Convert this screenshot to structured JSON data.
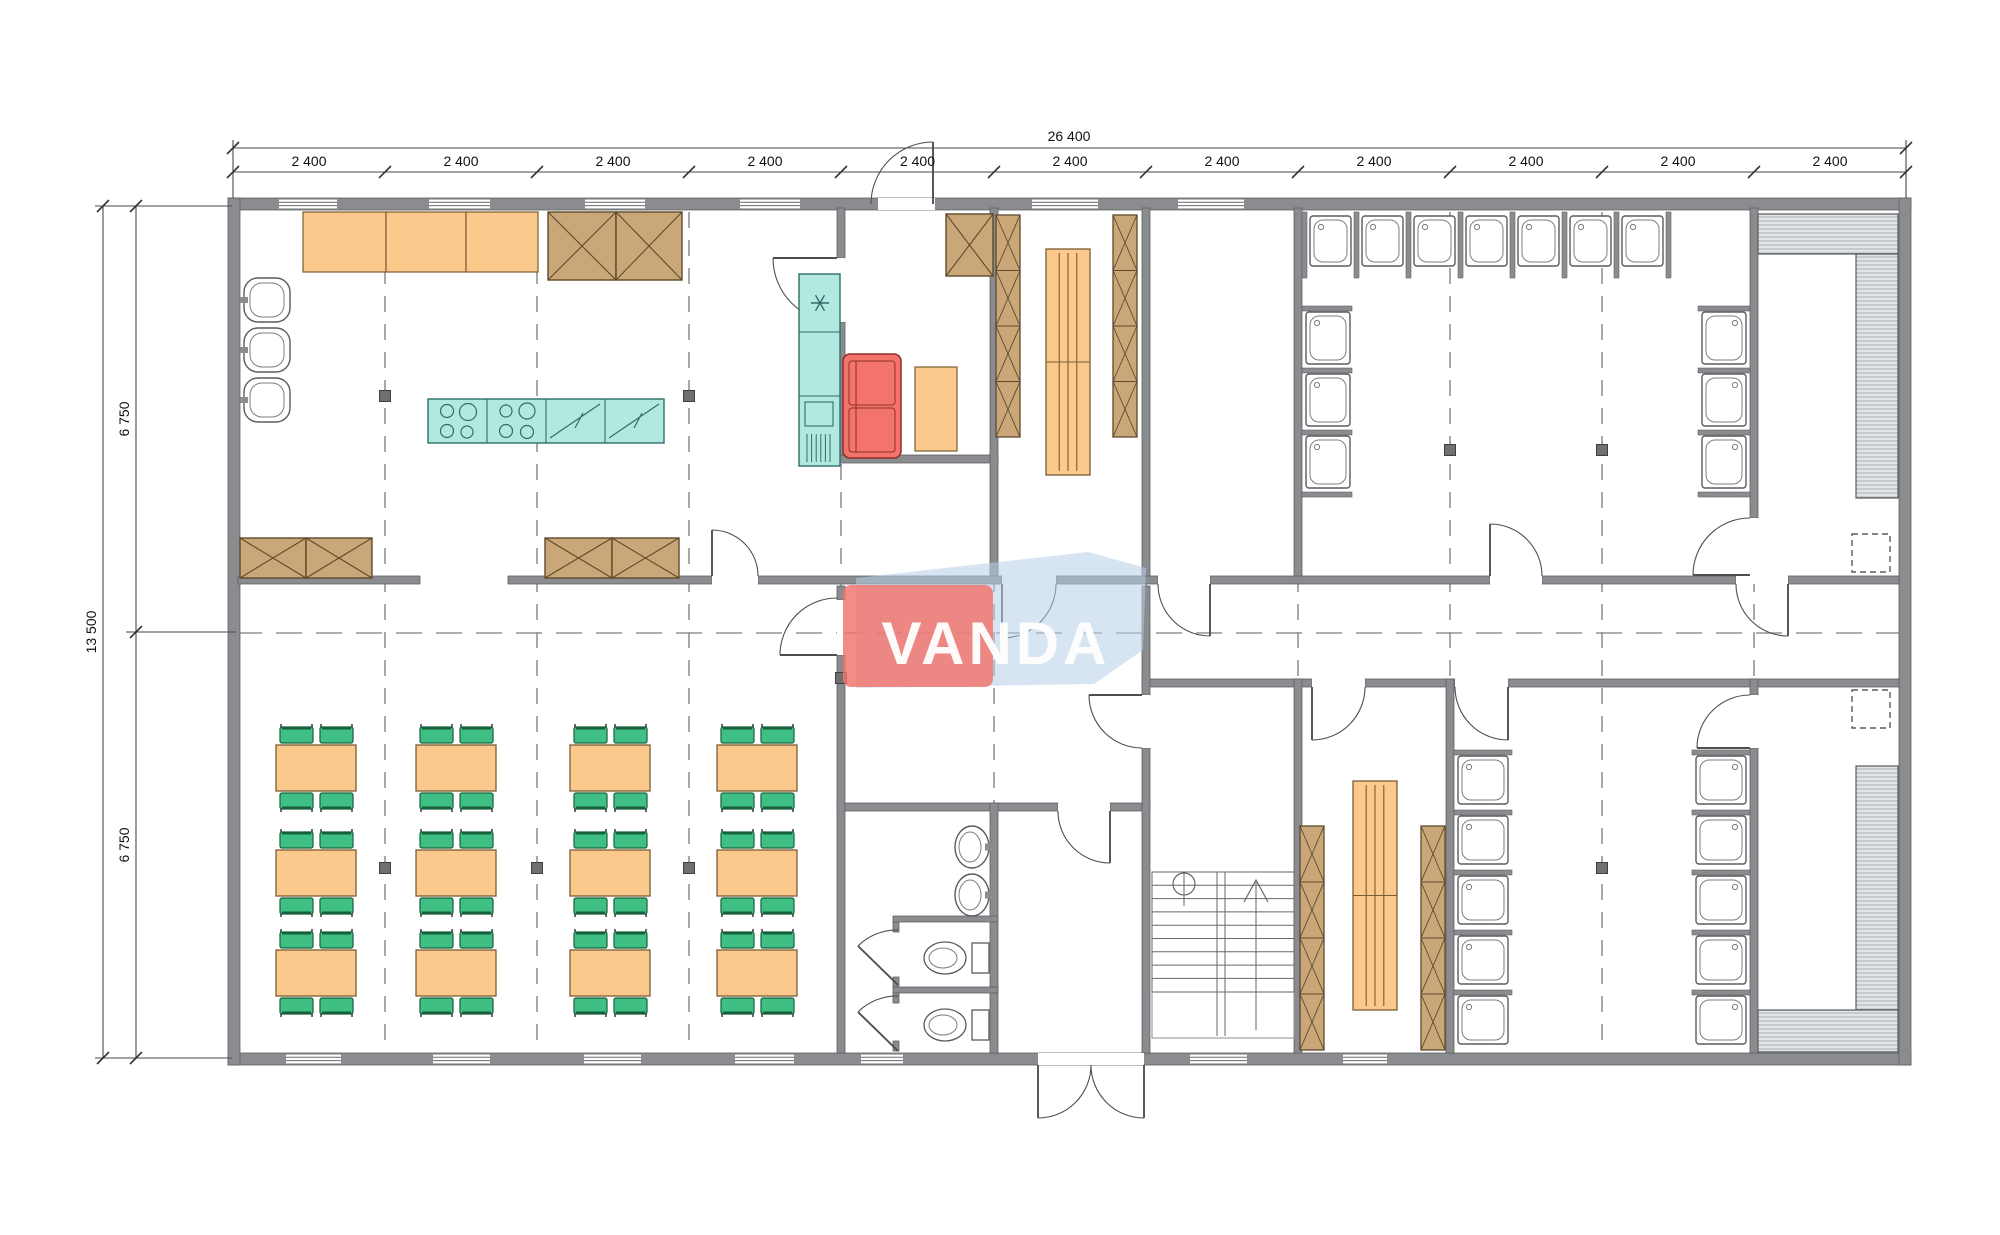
{
  "page": {
    "title": "Modular building floor plan"
  },
  "watermark": {
    "text": "VANDA"
  },
  "dimensions": {
    "overall_width_label": "26 400",
    "overall_height_label": "13 500",
    "top_segment_labels": [
      "2 400",
      "2 400",
      "2 400",
      "2 400",
      "2 400",
      "2 400",
      "2 400",
      "2 400",
      "2 400",
      "2 400",
      "2 400"
    ],
    "left_segment_labels": [
      "6 750",
      "6 750"
    ]
  },
  "counts": {
    "dining_tables": 12,
    "chairs_per_table": 4,
    "kitchen_wall_sinks": 3,
    "washroom_basins": 2,
    "washroom_toilets": 2,
    "shower_stalls_top_room": 13,
    "shower_stalls_bottom_room": 10
  },
  "colors": {
    "wall": "#8a8c8f",
    "wall_stroke": "#5f6163",
    "furniture_orange": "#fbc98c",
    "orange_stroke": "#7a5c33",
    "chair_green": "#3fbf83",
    "chair_stroke": "#17603c",
    "cabinet_brown": "#c9a779",
    "cabinet_stroke": "#5f4a2a",
    "kitchen_teal": "#b2e8e0",
    "teal_stroke": "#2f6e68",
    "sofa_red": "#f3746c",
    "sofa_stroke": "#8f2f28",
    "fixture_stroke": "#595b5d",
    "grid_grey": "#909294",
    "column_grey": "#6e7072",
    "dim_line": "#4a4a4a",
    "dim_text": "#111111",
    "logo_red": "#f2726a",
    "logo_blue": "#b7cfe9",
    "logo_text": "#ffffff"
  }
}
